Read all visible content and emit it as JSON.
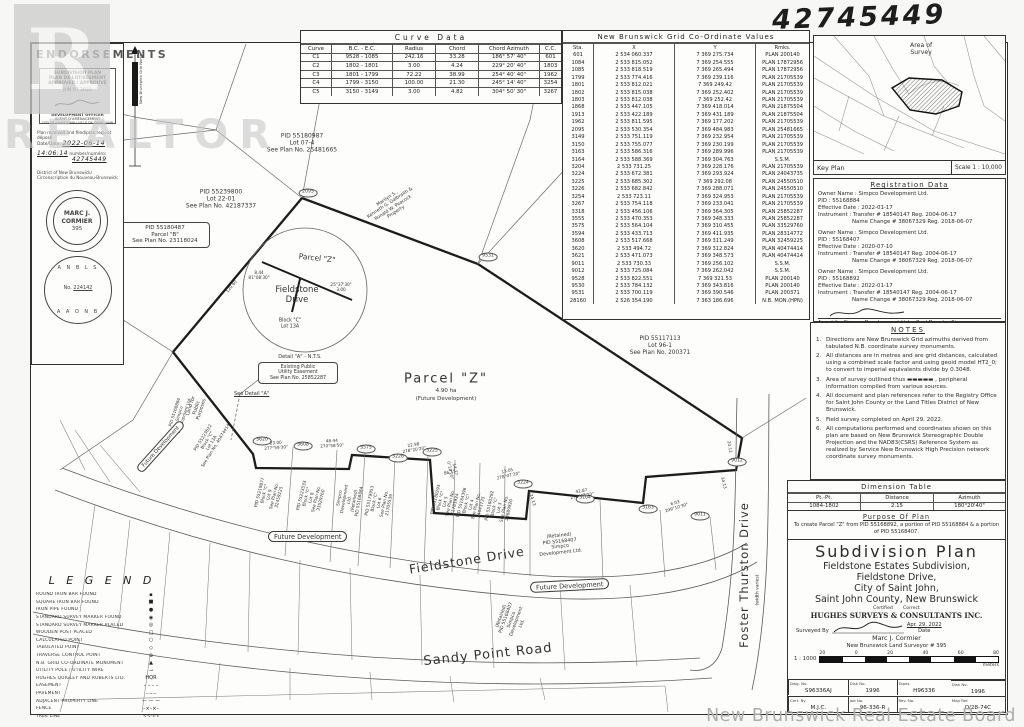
{
  "watermarks": {
    "realtor_letter": "R",
    "realtor_word": "REALTOR",
    "board": "New Brunswick Real Estate Board"
  },
  "handwritten_number": "42745449",
  "endorsements": {
    "title": "ENDORSEMENTS",
    "stamp": {
      "line1": "SUBDIVISION PLAN",
      "line2": "PLAN DE LOTISSEMENT",
      "line3": "APPROVED / APPROUVÉ",
      "date": "JUN 07 2022",
      "officer1": "DEVELOPMENT OFFICER",
      "officer2": "AGENT D'AMÉNAGEMENT",
      "officer3": "CITY OF SAINT JOHN / VILLE DE SAINT JOHN"
    },
    "received": "Plan received and filed/plan reçu et déposé",
    "date_label": "Date/Date:",
    "date_value": "2022-06-14",
    "time_label": "Time/heure:",
    "time_value": "14:06:14",
    "number_label": "number/numéro:",
    "number_value": "42745449",
    "district1": "District of New Brunswick/",
    "district2": "Circonscription du Nouveau-Brunswick",
    "seal1": {
      "name1": "MARC J.",
      "name2": "CORMIER",
      "number": "395"
    },
    "seal2": {
      "top": "A N B L S",
      "no_label": "No.",
      "number": "224142",
      "bottom": "A A O N B"
    }
  },
  "north_arrow": {
    "label": "New Brunswick Grid North"
  },
  "curve_table": {
    "title": "Curve  Data",
    "headers": [
      "Curve",
      "B.C. - E.C.",
      "Radius",
      "Chord",
      "Chord Azimuth",
      "C.C."
    ],
    "rows": [
      [
        "C1",
        "9528 - 1085",
        "242.16",
        "33.28",
        "186° 57' 40\"",
        "601"
      ],
      [
        "C2",
        "1802 - 1801",
        "3.00",
        "4.24",
        "229° 20' 40\"",
        "1803"
      ],
      [
        "C3",
        "1801 - 1799",
        "72.22",
        "38.99",
        "254° 40' 40\"",
        "1962"
      ],
      [
        "C4",
        "1799 - 3150",
        "100.00",
        "21.30",
        "245° 14' 40\"",
        "3254"
      ],
      [
        "C5",
        "3150 - 3149",
        "3.00",
        "4.82",
        "304° 50' 30\"",
        "3267"
      ]
    ]
  },
  "coordinate_table": {
    "title": "New   Brunswick   Grid   Co-Ordinate   Values",
    "headers": [
      "Sta.",
      "X",
      "Y",
      "Rmks."
    ],
    "rows": [
      [
        "601",
        "2 534 060.337",
        "7 369 275.734",
        "PLAN 200140"
      ],
      [
        "1084",
        "2 533 815.052",
        "7 369 254.555",
        "PLAN 17872956"
      ],
      [
        "1085",
        "2 533 818.519",
        "7 369 265.494",
        "PLAN 17872956"
      ],
      [
        "1799",
        "2 533 774.416",
        "7 369 239.116",
        "PLAN 21705539"
      ],
      [
        "1801",
        "2 533 812.021",
        "7 369 249.42",
        "PLAN 21705539"
      ],
      [
        "1802",
        "2 533 815.038",
        "7 369 252.402",
        "PLAN 21705539"
      ],
      [
        "1803",
        "2 533 812.038",
        "7 369 252.42",
        "PLAN 21705539"
      ],
      [
        "1868",
        "2 533 447.105",
        "7 369 418.014",
        "PLAN 21875504"
      ],
      [
        "1913",
        "2 533 422.189",
        "7 369 431.189",
        "PLAN 21875504"
      ],
      [
        "1962",
        "2 533 811.595",
        "7 369 177.202",
        "PLAN 21705539"
      ],
      [
        "2095",
        "2 533 530.354",
        "7 369 484.983",
        "PLAN 25481665"
      ],
      [
        "3149",
        "2 533 751.119",
        "7 369 232.954",
        "PLAN 21705539"
      ],
      [
        "3150",
        "2 533 755.077",
        "7 369 230.199",
        "PLAN 21705539"
      ],
      [
        "3163",
        "2 533 586.316",
        "7 369 289.996",
        "PLAN 21705539"
      ],
      [
        "3164",
        "2 533 588.369",
        "7 369 304.763",
        "S.S.M."
      ],
      [
        "3204",
        "2 533 731.25",
        "7 369 228.176",
        "PLAN 21705539"
      ],
      [
        "3224",
        "2 533 672.381",
        "7 369 293.924",
        "PLAN 24043735"
      ],
      [
        "3225",
        "2 533 685.302",
        "7 369 292.08",
        "PLAN 24550510"
      ],
      [
        "3226",
        "2 533 682.842",
        "7 369 288.071",
        "PLAN 24550510"
      ],
      [
        "3254",
        "2 533 723.11",
        "7 369 324.953",
        "PLAN 21705539"
      ],
      [
        "3267",
        "2 533 754.118",
        "7 369 233.041",
        "PLAN 21705539"
      ],
      [
        "3318",
        "2 533 456.106",
        "7 369 364.305",
        "PLAN 25852287"
      ],
      [
        "3555",
        "2 533 470.353",
        "7 369 348.333",
        "PLAN 25852287"
      ],
      [
        "3575",
        "2 533 564.104",
        "7 369 310.455",
        "PLAN 33529760"
      ],
      [
        "3594",
        "2 533 433.713",
        "7 369 411.935",
        "PLAN 28314772"
      ],
      [
        "3608",
        "2 533 517.668",
        "7 369 311.249",
        "PLAN 32459225"
      ],
      [
        "3620",
        "2 533 494.72",
        "7 369 312.824",
        "PLAN 40474414"
      ],
      [
        "3621",
        "2 533 471.073",
        "7 369 348.573",
        "PLAN 40474414"
      ],
      [
        "9011",
        "2 533 730.33",
        "7 369 256.102",
        "S.S.M."
      ],
      [
        "9012",
        "2 533 725.084",
        "7 369 262.042",
        "S.S.M."
      ],
      [
        "9528",
        "2 533 822.551",
        "7 369 321.53",
        "PLAN 200140"
      ],
      [
        "9530",
        "2 533 784.132",
        "7 369 343.816",
        "PLAN 200140"
      ],
      [
        "9531",
        "2 533 700.119",
        "7 369 390.546",
        "PLAN 200371"
      ],
      [
        "28160",
        "2 526 354.190",
        "7 363 186.696",
        "N.B. MON.(HPN)"
      ]
    ]
  },
  "key_plan": {
    "area_label": "Area of\nSurvey",
    "caption": "Key Plan",
    "scale": "Scale 1 : 10,000"
  },
  "registration": {
    "title": "Registration        Data",
    "entries": [
      {
        "owner": "Owner Name : Simpco Development Ltd.",
        "pid": "PID : 55168884",
        "effective": "Effective Date : 2022-01-17",
        "instrument": "Instrument : Transfer # 18540147  Reg. 2004-06-17",
        "name_change": "Name Change # 38067329  Reg. 2018-06-07"
      },
      {
        "owner": "Owner Name : Simpco Development Ltd.",
        "pid": "PID : 55168407",
        "effective": "Effective Date : 2020-07-10",
        "instrument": "Instrument : Transfer # 18540147  Reg. 2004-06-17",
        "name_change": "Name Change # 38067329  Reg. 2018-06-07"
      },
      {
        "owner": "Owner Name : Simpco Development Ltd.",
        "pid": "PID : 55168892",
        "effective": "Effective Date : 2022-01-17",
        "instrument": "Instrument : Transfer # 18540147  Reg. 2004-06-17",
        "name_change": "Name Change # 38067329  Reg. 2018-06-07"
      }
    ],
    "agent_line": "Agent for  Simpco Development Ltd.  -  Paul Douglas Simpson  -  President"
  },
  "notes": {
    "title": "NOTES",
    "items": [
      {
        "n": "1.",
        "t": "Directions are New Brunswick Grid azimuths derived from tabulated N.B. coordinate survey monuments."
      },
      {
        "n": "2.",
        "t": "All distances are in metres and are grid distances, calculated using a combined scale factor and using geoid model HT2_0; to convert to imperial equivalents divide by 0.3048."
      },
      {
        "n": "3.",
        "t": "Area of survey outlined thus ▬▬▬▬▬ , peripheral information compiled from various sources."
      },
      {
        "n": "4.",
        "t": "All document and plan references refer to the Registry Office for Saint John County or the Land Titles District of New Brunswick."
      },
      {
        "n": "5.",
        "t": "Field survey completed on April 29, 2022."
      },
      {
        "n": "6.",
        "t": "All computations performed and coordinates shown on this plan are based on New Brunswick Stereographic Double Projection and the NAD83(CSRS) Reference System as realized by Service New Brunswick High Precision network coordinate survey monuments."
      }
    ]
  },
  "dimension_table": {
    "title": "Dimension     Table",
    "headers": [
      "Pt.-Pt.",
      "Distance",
      "Azimuth"
    ],
    "rows": [
      [
        "1084-1802",
        "2.15",
        "180°20'40\""
      ]
    ]
  },
  "purpose": {
    "title": "Purpose  Of  Plan",
    "text": "To create Parcel \"Z\" from PID 55168892, a portion of PID 55168884 & a portion of PID 55168407."
  },
  "title_block": {
    "title": "Subdivision  Plan",
    "sub1": "Fieldstone Estates Subdivision,",
    "sub2": "Fieldstone Drive,",
    "sub3": "City of Saint John,",
    "sub4": "Saint John County, New Brunswick",
    "certified": "Certified",
    "correct": "Correct",
    "firm": "HUGHES  SURVEYS  &  CONSULTANTS  INC.",
    "surveyed_by": "Surveyed  By",
    "surveyor": "Marc J. Cormier",
    "date": "Apr. 29, 2022",
    "date_label": "Date",
    "surveyor_title": "New     Brunswick     Land     Surveyor   #   395",
    "scale_ratio": "1 : 1000",
    "scale_ticks": [
      "20",
      "0",
      "20",
      "40",
      "60",
      "80"
    ],
    "meters": "meters",
    "info_cells": [
      {
        "label": "Dwg. No.",
        "value": "S96336AJ"
      },
      {
        "label": "Disk No.",
        "value": "1996"
      },
      {
        "label": "Tapes",
        "value": "H96336"
      },
      {
        "label": "Disk No.",
        "value": "1996"
      },
      {
        "label": "Cert. By",
        "value": "M.J.C."
      },
      {
        "label": "Job No.",
        "value": "96-336-R"
      },
      {
        "label": "Rev. No.",
        "value": ""
      },
      {
        "label": "Map Ref.",
        "value": "O/28-74C"
      }
    ]
  },
  "legend": {
    "title": "L E G E N D",
    "items": [
      {
        "sym": "▪",
        "label": "ROUND IRON BAR FOUND"
      },
      {
        "sym": "■",
        "label": "SQUARE IRON BAR FOUND"
      },
      {
        "sym": "●",
        "label": "IRON PIPE FOUND"
      },
      {
        "sym": "◉",
        "label": "STANDARD SURVEY MARKER FOUND"
      },
      {
        "sym": "◎",
        "label": "STANDARD SURVEY MARKER PLACED"
      },
      {
        "sym": "□",
        "label": "WOODEN POST PLACED"
      },
      {
        "sym": "○",
        "label": "CALCULATED POINT"
      },
      {
        "sym": "◇",
        "label": "TABULATED POINT"
      },
      {
        "sym": "⊕",
        "label": "TRAVERSE CONTROL POINT"
      },
      {
        "sym": "▲",
        "label": "N.B. GRID CO-ORDINATE MONUMENT"
      },
      {
        "sym": "⊸",
        "label": "UTILITY POLE / UTILITY WIRE"
      },
      {
        "sym": "HQR",
        "label": "HUGHES QUIGLEY AND ROBERTS LTD."
      },
      {
        "sym": "– – – –",
        "label": "EASEMENT"
      },
      {
        "sym": "–·–·–",
        "label": "PAVEMENT"
      },
      {
        "sym": "— — —",
        "label": "ADJACENT PROPERTY LINE"
      },
      {
        "sym": "–×–×–",
        "label": "FENCE"
      },
      {
        "sym": "∿∿∿∿",
        "label": "TREE LINE"
      }
    ]
  },
  "drawing": {
    "lot07_4": "PID 55180987\nLot  07-4\nSee Plan No. 25481665",
    "lot22_01": "PID 55239800\nLot  22-01\nSee Plan No. 42187337",
    "parcel_b": "PID 55180487\nParcel  \"B\"\nSee Plan No. 23118024",
    "peacock": "Marilyn S.,\nKenneth G. Galbraith &\nRonald W. Peacock\nProperty",
    "detail_parcel_z": "Parcel  \"Z\"",
    "detail_street": "Fieldstone\nDrive",
    "detail_block": "Block \"C\"\nLot 13A",
    "detail_dim1": "8.44\n81°08'30\"",
    "detail_dim2": "25°37'30\"\n3.00",
    "detail_caption": "Detail \"A\"  -  N.T.S.",
    "easement_box": "Existing Public\nUtility Easement\nSee Plan No. 25852287",
    "see_detail": "See Detail \"A\"",
    "parcel_z_main": "Parcel  \"Z\"",
    "parcel_z_area": "4.90 ha",
    "parcel_z_future": "(Future Development)",
    "lot96_1": "PID 55117113\nLot  96-1\nSee Plan No. 200371",
    "lpp": "Land for\nPublic\nPurposes",
    "simpco_left": "PID 55168884\nSimpco\nDevelopment Ltd.",
    "lot13a": "PID 55223622\nBlock \"C\"\nLot 13A\nSee Plan No. 40474414",
    "lot9": "PID 55219877\nBlock \"C\"\nLot 9\nSee Plan No.\n32459225",
    "lot8": "PID 55223533\nBlock \"C\"\nLot 8\nSee Plan No.\n33529760",
    "simpco_retained1": "Simpco\nDevelopment\nLtd.\n(Retained)\nPID 55168884",
    "lot6": "PID 55179953\nBlock \"C\"\nLot 6\nSee Plan No.\n21705539",
    "lot5": "PID 55180293\nBlock \"C\"\nLot 5\nSee Plan No.\n21783934",
    "lot4": "PID 55184396\nBlock \"C\"\nLot 4\nSee Plan No.\n24043735",
    "lot3": "PID 55180292\nBlock \"C\"\nLot 3\nSee Plan No.\n24889920",
    "simpco_retained2": "(Retained)\nPID 55168407\nSimpco\nDevelopment  Ltd.",
    "simpco_bottom": "(Retained)\nPID 55168407\nSimpco\nDevelopment\nLtd.",
    "future_development": "Future Development",
    "street_fieldstone": "Fieldstone   Drive",
    "street_sandy": "Sandy   Point   Road",
    "street_foster": "Foster   Thurston   Drive",
    "street_foster_note": "(width varies)",
    "station_tags": [
      "3620",
      "3608",
      "3575",
      "3226",
      "3225",
      "3224",
      "3164",
      "3163",
      "9011",
      "9012",
      "9531",
      "2095"
    ],
    "dim_labels": [
      "23.00\n277°59'30\"",
      "48.44\n270°58'50\"",
      "22.98\n278°20'20\"",
      "14.77\n0°18'20\"",
      "13.05\n278°07'20\"",
      "42.87\n278°07'20\"",
      "6.03\n299°10'30\"",
      "86.15",
      "24.13",
      "20.12",
      "34.13",
      "120.60"
    ]
  }
}
